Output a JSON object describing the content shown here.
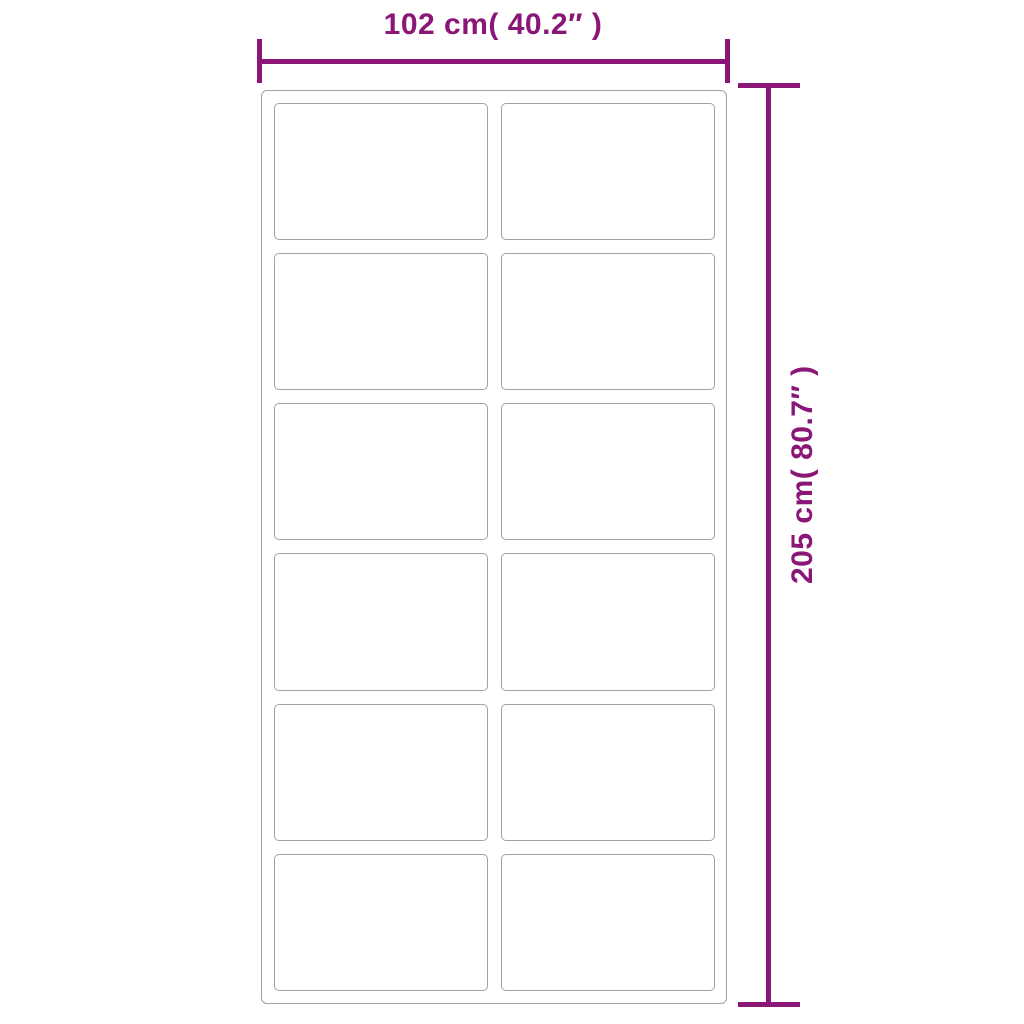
{
  "colors": {
    "accent": "#8a1678",
    "frame-line": "#a2a2a2"
  },
  "diagram": {
    "width_dimension": {
      "label": "102 cm( 40.2″ )",
      "value_cm": "102",
      "value_inch": "40.2"
    },
    "height_dimension": {
      "label": "205 cm( 80.7″ )",
      "value_cm": "205",
      "value_inch": "80.7"
    },
    "panel_grid": {
      "columns": 2,
      "rows": 6,
      "panel_count": 12
    }
  }
}
